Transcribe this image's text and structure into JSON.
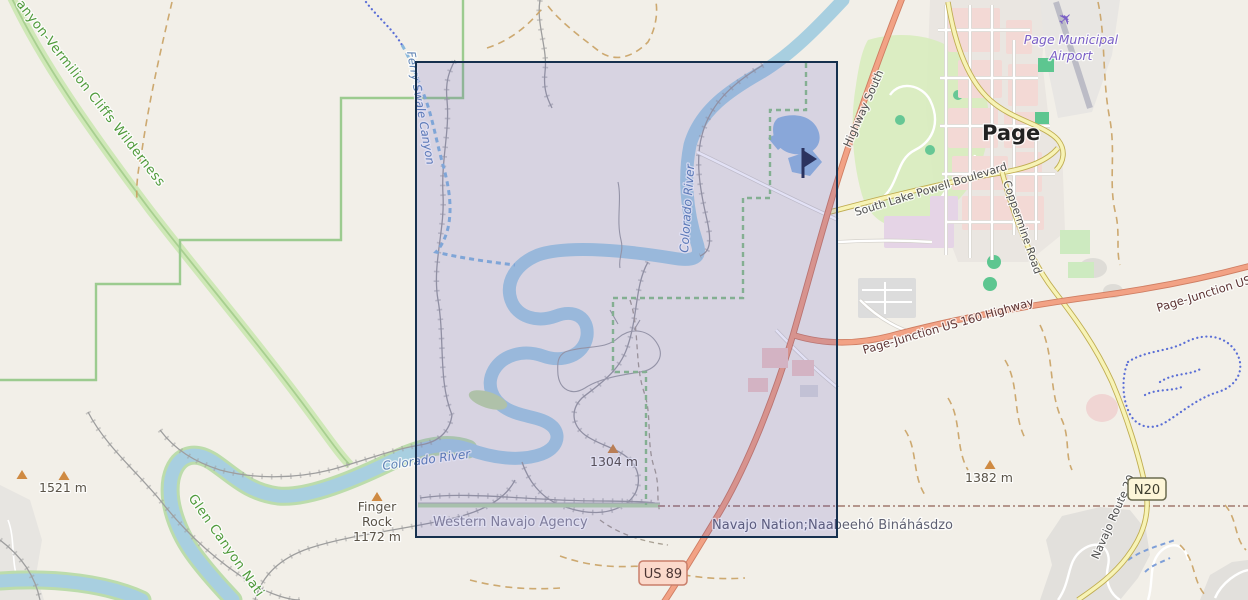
{
  "map": {
    "city": {
      "name": "Page"
    },
    "airport": {
      "line1": "Page Municipal",
      "line2": "Airport"
    },
    "roads": {
      "south_lake_powell_blvd": "South Lake Powell Boulevard",
      "coppermine_road": "Coppermine Road",
      "highway_south": "Highway South",
      "page_junction_us160": "Page-Junction US 160 Highway",
      "page_junction_us160_partial": "Page-Junction US 1",
      "navajo_route_20": "Navajo Route 20"
    },
    "shields": {
      "n20": "N20",
      "us89": "US 89"
    },
    "water": {
      "colorado_river_upper": "Colorado River",
      "colorado_river_lower": "Colorado River",
      "ferry_swale_canyon": "Ferry-Swale Canyon"
    },
    "protected": {
      "vermilion_cliffs": "anyon-Vermilion Cliffs Wilderness",
      "glen_canyon": "Glen Canyon Nati"
    },
    "admin": {
      "western_navajo_agency": "Western Navajo Agency",
      "navajo_nation": "Navajo Nation;Naabeehó Bináhásdzo"
    },
    "peaks": {
      "p1521": "1521 m",
      "p1304": "1304 m",
      "p1382": "1382 m",
      "finger_rock_line1": "Finger",
      "finger_rock_line2": "Rock",
      "finger_rock_line3": "1172 m"
    },
    "icons": {
      "airplane": "✈"
    },
    "colors": {
      "land": "#f2efe8",
      "water": "#a8cfe0",
      "trunk_road": "#f2a285",
      "secondary_road": "#f7f3b6",
      "selection_border": "#16304e",
      "selection_fill": "rgba(72,70,195,0.16)",
      "protected_green": "#4e9a3a",
      "water_label_blue": "#5e82b5",
      "airport_purple": "#7a5fc6",
      "peak_orange": "#cf8a42"
    }
  }
}
